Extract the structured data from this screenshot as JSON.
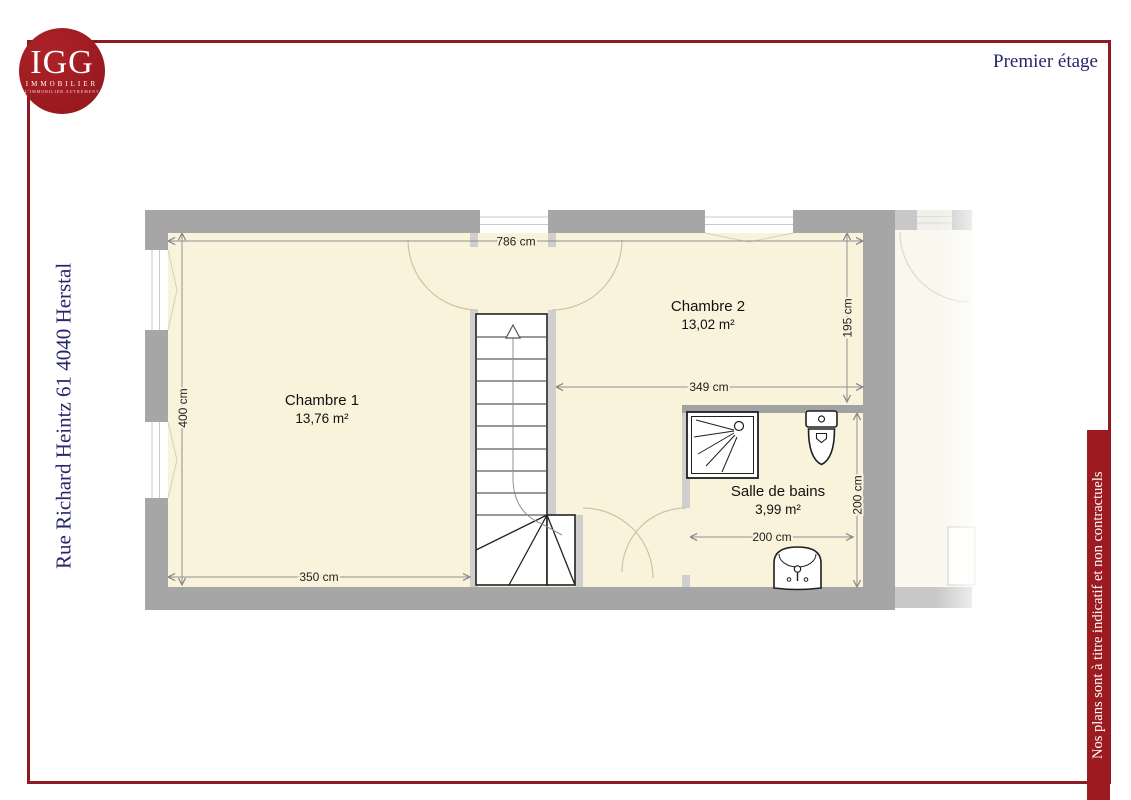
{
  "header": {
    "floor_title": "Premier étage",
    "logo": {
      "monogram": "IGG",
      "name": "IMMOBILIER",
      "tagline": "L'IMMOBILIER AUTREMENT"
    }
  },
  "left_margin": {
    "address": "Rue Richard Heintz 61 4040 Herstal"
  },
  "right_margin": {
    "disclaimer": "Nos plans sont à titre indicatif et non contractuels"
  },
  "plan": {
    "overall_width_label": "786 cm",
    "rooms": [
      {
        "name": "Chambre 1",
        "area": "13,76 m²",
        "width_label": "350 cm",
        "height_label": "400 cm"
      },
      {
        "name": "Chambre 2",
        "area": "13,02 m²",
        "width_label": "349 cm",
        "height_label": "195 cm"
      },
      {
        "name": "Salle de bains",
        "area": "3,99 m²",
        "width_label": "200 cm",
        "height_label": "200 cm"
      }
    ]
  },
  "colors": {
    "brand_red": "#9c1b20",
    "navy_text": "#26266b",
    "exterior_wall": "#a6a6a6",
    "partition_wall": "#cfcfcf",
    "room_fill": "#faf3dc"
  }
}
